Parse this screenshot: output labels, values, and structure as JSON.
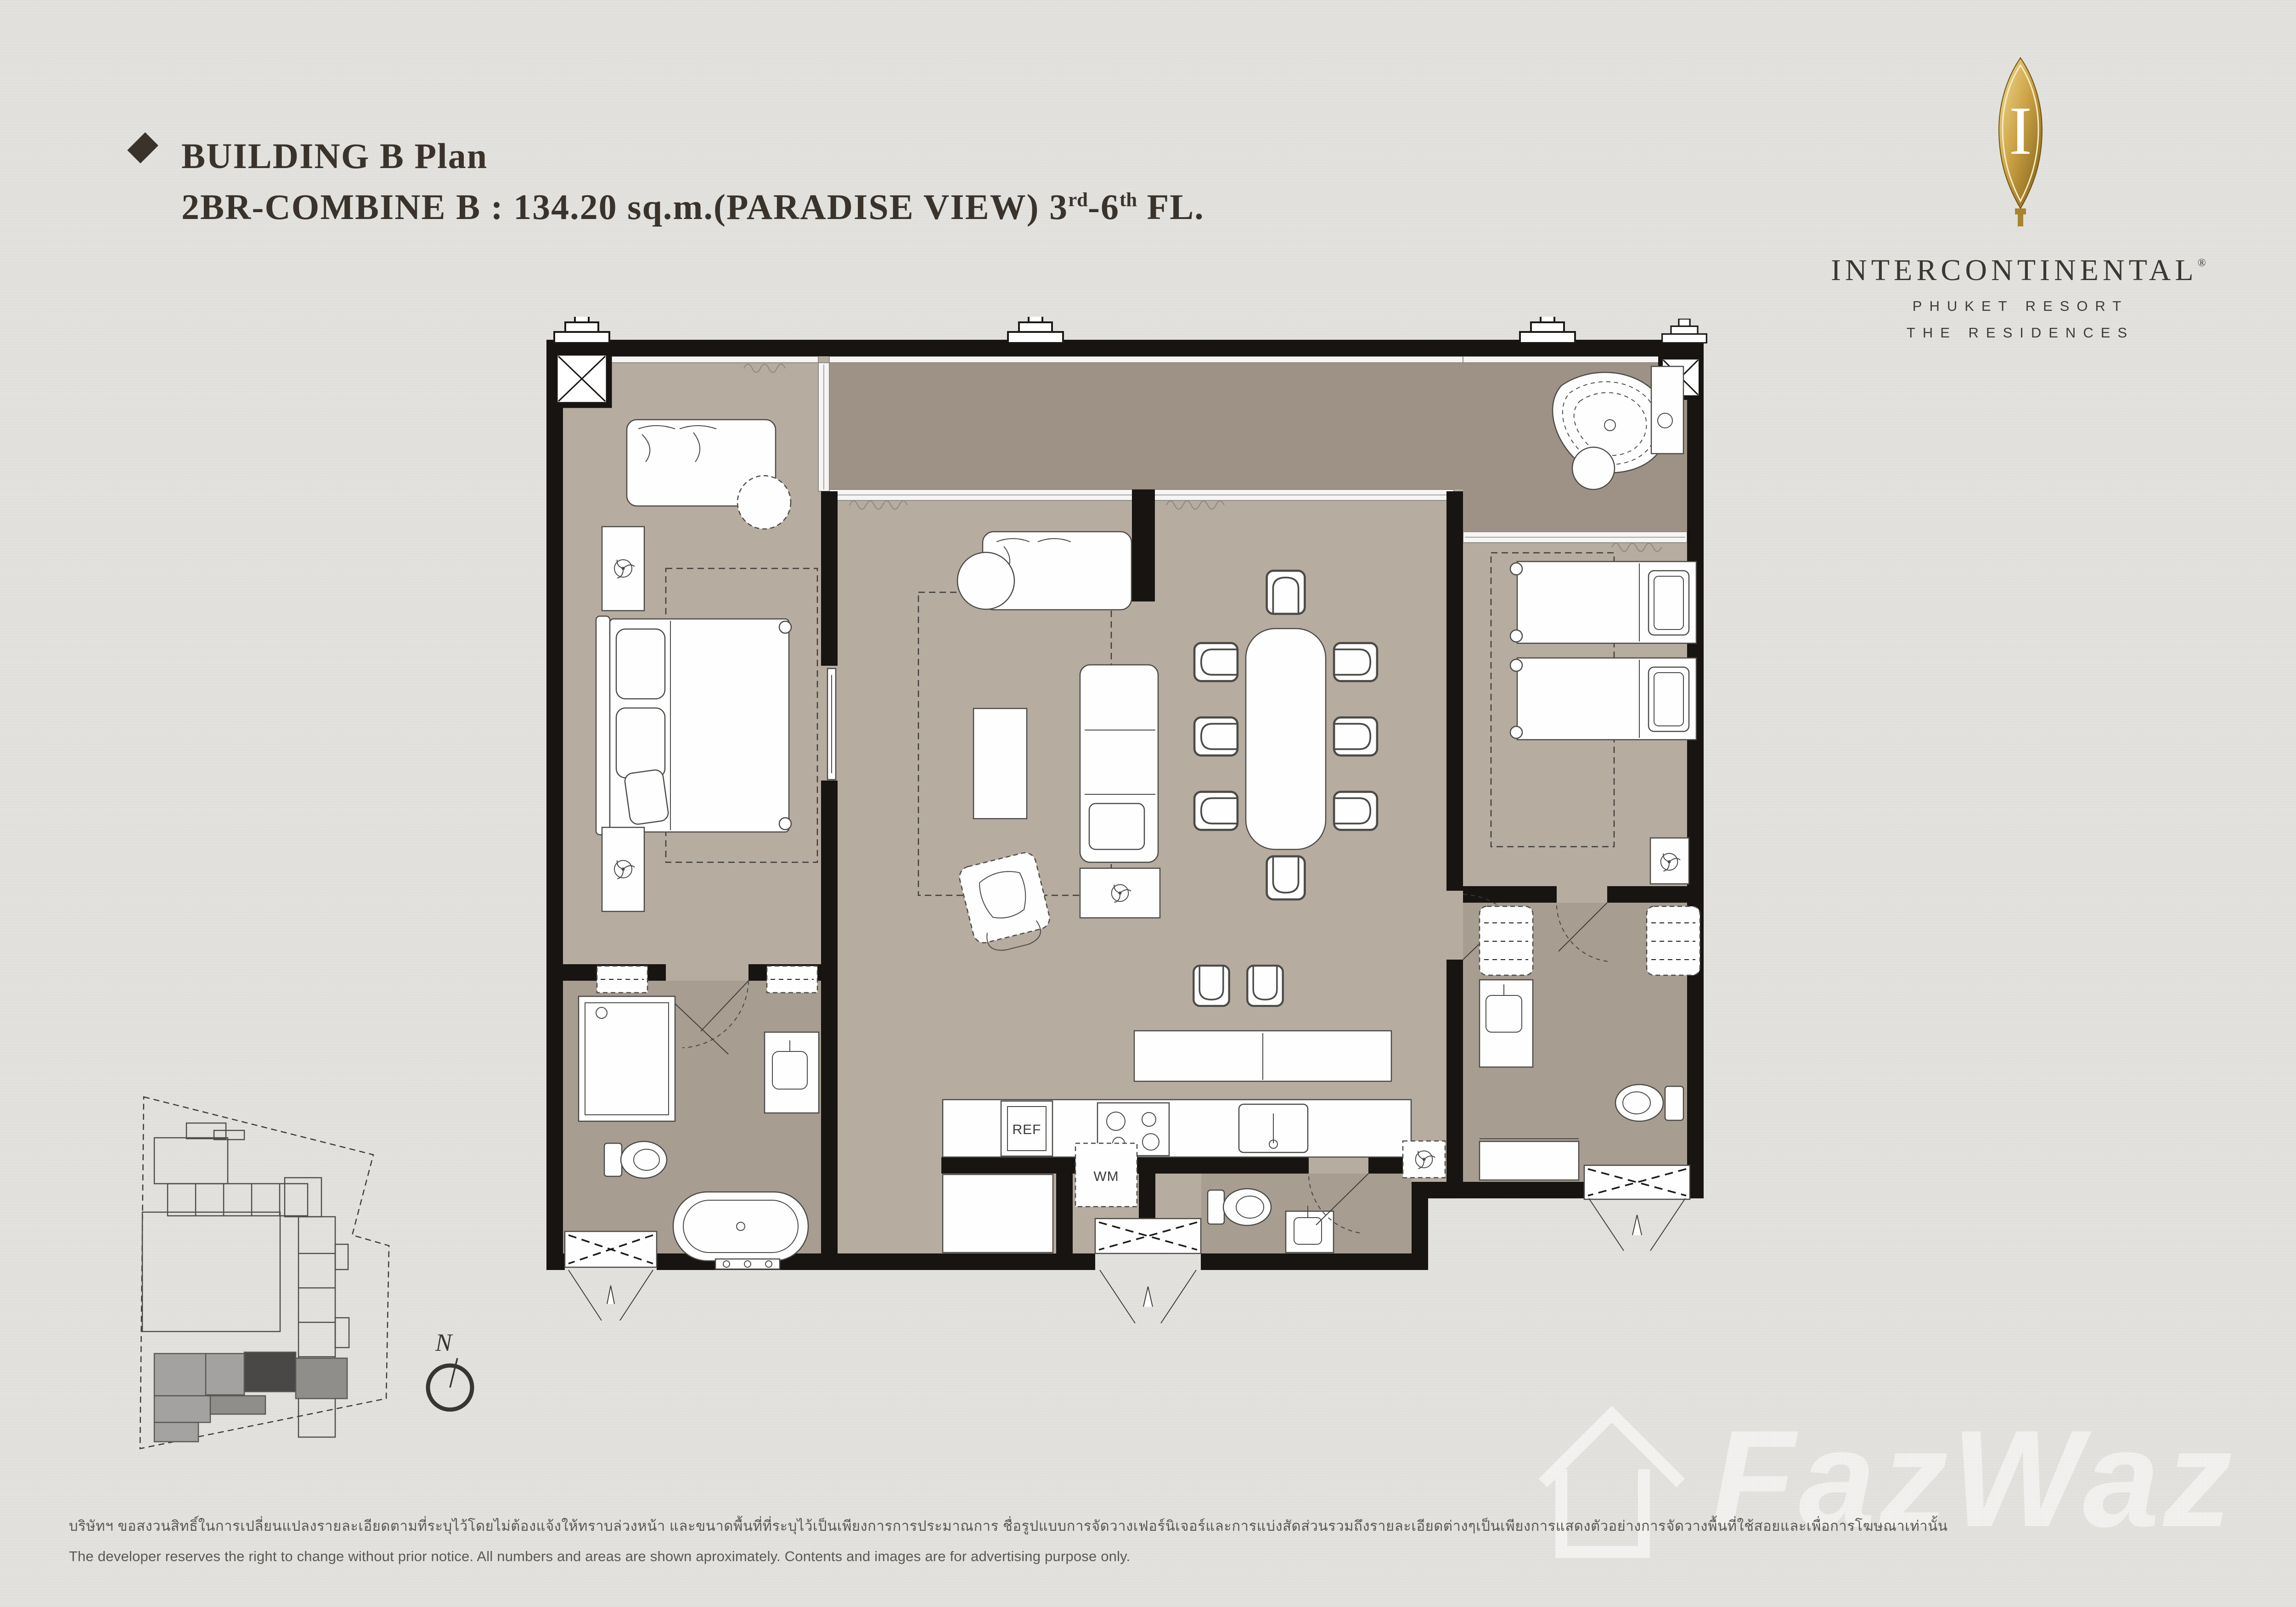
{
  "header": {
    "bullet_icon": "diamond-bullet",
    "title_line1": "BUILDING B Plan",
    "title_line2": {
      "main": "2BR-COMBINE B : 134.20 sq.m.(PARADISE VIEW) ",
      "floor_start": "3",
      "floor_start_sup": "rd",
      "floor_sep": "-",
      "floor_end": "6",
      "floor_end_sup": "th",
      "tail": " FL."
    },
    "text_color": "#3a332c"
  },
  "logo": {
    "monogram": "I",
    "brand": "INTERCONTINENTAL",
    "registered": "®",
    "subtitle1": "PHUKET RESORT",
    "subtitle2": "THE RESIDENCES",
    "gold_light": "#ecd287",
    "gold_dark": "#7d5c14",
    "text_color": "#3b3733"
  },
  "plan": {
    "labels": {
      "refrigerator": "REF",
      "washing_machine": "WM"
    },
    "colors": {
      "wall": "#171411",
      "floor": "#b7aca0",
      "terrace": "#9d9285",
      "bathroom": "#a89d91",
      "paper": "#e2e1dd"
    }
  },
  "site_map": {
    "north_label": "N"
  },
  "footer": {
    "line1_thai": "บริษัทฯ ขอสงวนสิทธิ์ในการเปลี่ยนแปลงรายละเอียดตามที่ระบุไว้โดยไม่ต้องแจ้งให้ทราบล่วงหน้า และขนาดพื้นที่ที่ระบุไว้เป็นเพียงการการประมาณการ ชื่อรูปแบบการจัดวางเฟอร์นิเจอร์และการแบ่งสัดส่วนรวมถึงรายละเอียดต่างๆเป็นเพียงการแสดงตัวอย่างการจัดวางพื้นที่ใช้สอยและเพื่อการโฆษณาเท่านั้น",
    "line2_english": "The developer reserves the right to change without prior notice. All numbers and areas are shown aproximately. Contents and images are for advertising purpose only."
  },
  "watermark": {
    "icon": "house-watermark-icon",
    "text": "FazWaz"
  }
}
